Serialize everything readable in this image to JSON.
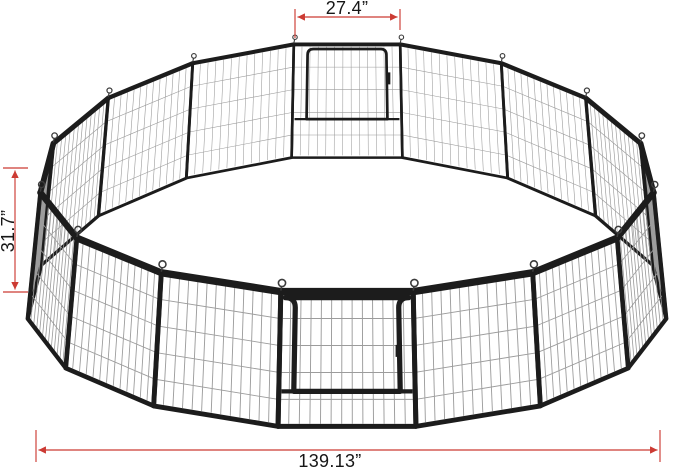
{
  "page": {
    "background": "#ffffff"
  },
  "diagram": {
    "description": "Circular 16-panel heavy-duty metal pet playpen shown in perspective with a back door and a front door",
    "annotation_color": "#cc3b33",
    "text_color": "#161616",
    "dimensions": {
      "door_panel_width": "27.4”",
      "panel_height": "31.7”",
      "overall_diameter": "139.13”"
    },
    "fence": {
      "panel_count": 16,
      "has_front_door": true,
      "has_back_door": true,
      "frame_color": "#1c1c1c",
      "mesh_color": "#9c9c9c",
      "hook_color": "#3c3c3c"
    }
  }
}
